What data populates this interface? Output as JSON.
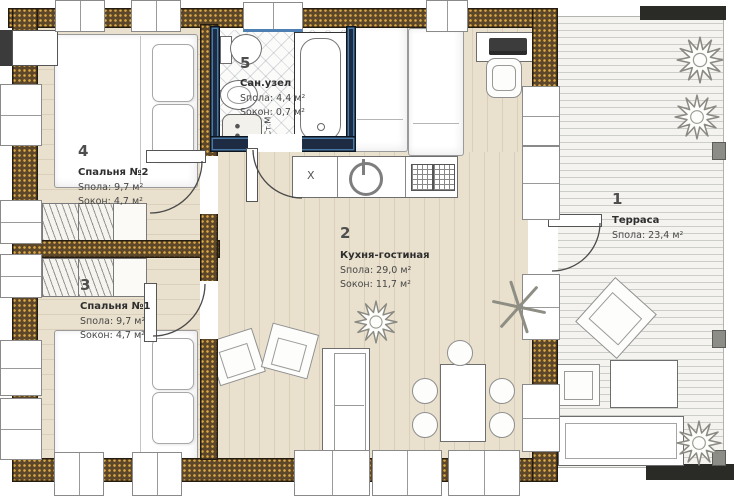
{
  "palette": {
    "wall_brown": "#5c472b",
    "wall_dots": "#dca944",
    "bathroom_wall": "#1d2c42",
    "bathroom_accent": "#4d7fb3",
    "floor_wood": "#e9e0cd",
    "terrace_deck": "#f4f3f0",
    "outline_dark": "#241c10",
    "text": "#474747"
  },
  "rooms": {
    "terrace": {
      "number": "1",
      "name": "Терраса",
      "floor_area": "Sпола: 23,4 м²"
    },
    "kitchen_living": {
      "number": "2",
      "name": "Кухня-гостиная",
      "floor_area": "Sпола: 29,0 м²",
      "window_area": "Sокон: 11,7 м²"
    },
    "bedroom1": {
      "number": "3",
      "name": "Спальня №1",
      "floor_area": "Sпола: 9,7 м²",
      "window_area": "Sокон: 4,7 м²"
    },
    "bedroom2": {
      "number": "4",
      "name": "Спальня №2",
      "floor_area": "Sпола: 9,7 м²",
      "window_area": "Sокон: 4,7 м²"
    },
    "bathroom": {
      "number": "5",
      "name": "Сан.узел",
      "floor_area": "Sпола: 4,4 м²",
      "window_area": "Sокон: 0,7 м²"
    }
  },
  "annotations": {
    "washing_machine": "Ст.М",
    "kitchen_mark": "X"
  }
}
